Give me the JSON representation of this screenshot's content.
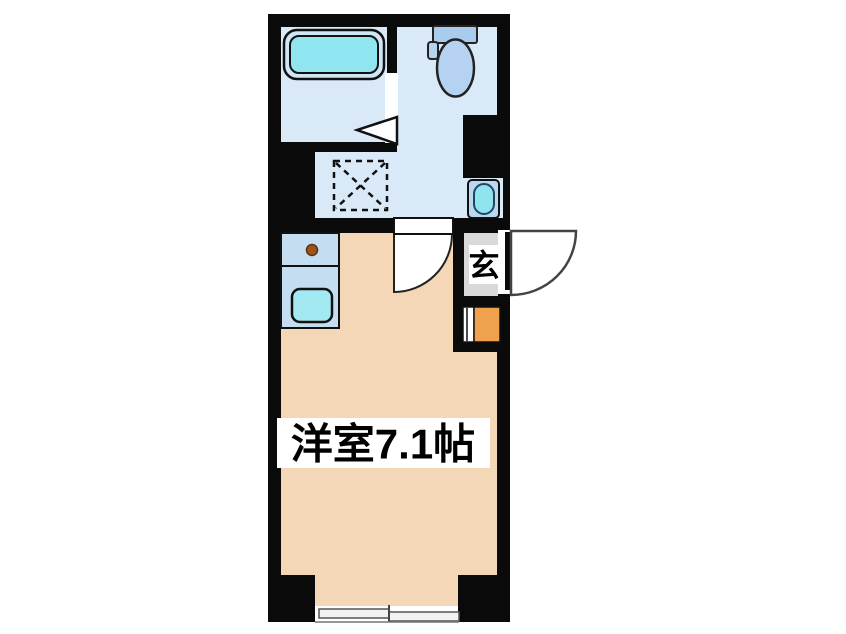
{
  "floorplan": {
    "type": "apartment-floor-plan",
    "room_label": "洋室7.1帖",
    "entrance_label": "玄",
    "colors": {
      "wall": "#0a0a0a",
      "wet_area_floor": "#DAE9F7",
      "main_room_floor": "#F4D7B7",
      "corridor_floor": "#D9D9D9",
      "kitchen_counter": "#C5DDF1",
      "shoe_cabinet_orange": "#F0A14E",
      "bathtub_rim": "#CFE6F6",
      "bathtub_water": "#8FE6F0",
      "kitchen_sink_water": "#A2E9F1",
      "basin_box": "#B8D9F0",
      "basin_water": "#8FE4EE",
      "toilet_tank": "#A9CBEC",
      "toilet_bowl": "#B5D3F0",
      "burner_brown": "#9A541C",
      "door_white": "#FFFFFF",
      "window_pane": "#F2F2F2"
    }
  }
}
